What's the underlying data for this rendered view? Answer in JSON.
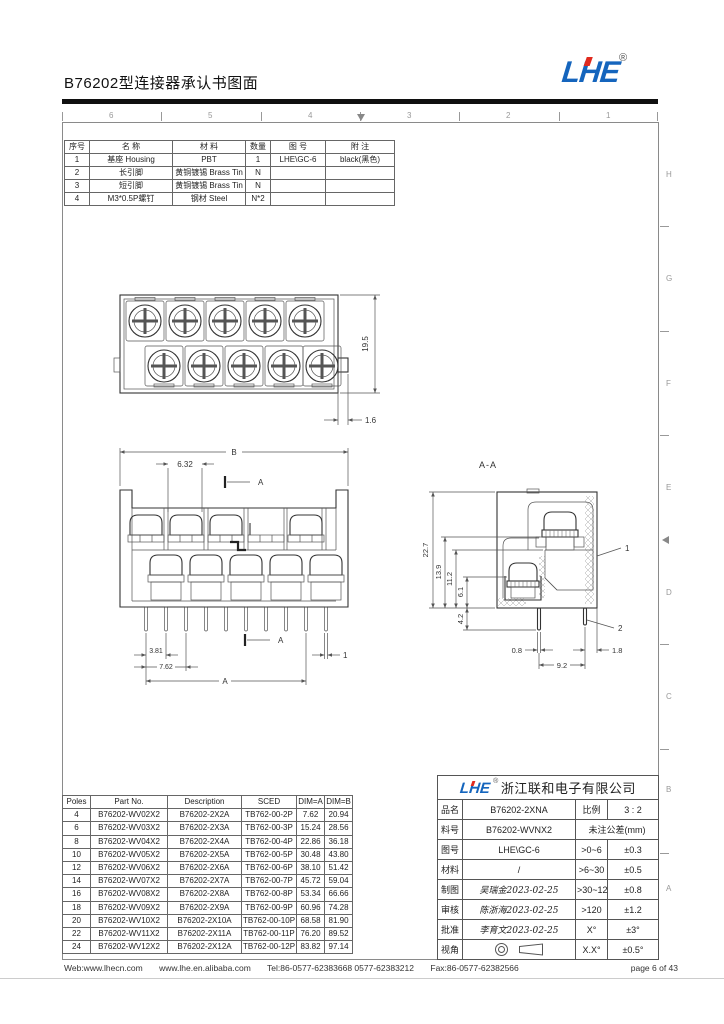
{
  "header": {
    "title": "B76202型连接器承认书图面",
    "logo_text": "LHE",
    "logo_reg": "®"
  },
  "sheet": {
    "top_zones": [
      "6",
      "5",
      "4",
      "3",
      "2",
      "1"
    ],
    "right_zones": [
      "H",
      "G",
      "F",
      "E",
      "D",
      "C",
      "B",
      "A"
    ]
  },
  "bom_table": {
    "headers": [
      "序号",
      "名    称",
      "材    料",
      "数量",
      "图    号",
      "附    注"
    ],
    "rows": [
      [
        "1",
        "基座 Housing",
        "PBT",
        "1",
        "LHE\\GC-6",
        "black(黑色)"
      ],
      [
        "2",
        "长引脚",
        "黄铜镀锡 Brass Tin",
        "N",
        "",
        ""
      ],
      [
        "3",
        "短引脚",
        "黄铜镀锡 Brass Tin",
        "N",
        "",
        ""
      ],
      [
        "4",
        "M3*0.5P螺钉",
        "钢材 Steel",
        "N*2",
        "",
        ""
      ]
    ]
  },
  "top_view": {
    "dim_height": "19.5",
    "dim_offset": "1.6"
  },
  "front_view": {
    "dim_b": "B",
    "dim_pitch": "6.32",
    "section_label_top": "A",
    "section_label_bottom": "A",
    "dim_3_81": "3.81",
    "dim_7_62": "7.62",
    "dim_a": "A",
    "dim_pin": "1"
  },
  "section_view": {
    "title": "A-A",
    "dim_total": "22.7",
    "dim_13_9": "13.9",
    "dim_11_2": "11.2",
    "dim_6_1": "6.1",
    "dim_4_2": "4.2",
    "dim_0_8": "0.8",
    "dim_9_2": "9.2",
    "dim_1_8": "1.8",
    "callout_1": "1",
    "callout_2": "2"
  },
  "poles_table": {
    "headers": [
      "Poles",
      "Part No.",
      "Description",
      "SCED",
      "DIM=A",
      "DIM=B"
    ],
    "rows": [
      [
        "4",
        "B76202-WV02X2",
        "B76202-2X2A",
        "TB762-00-2P",
        "7.62",
        "20.94"
      ],
      [
        "6",
        "B76202-WV03X2",
        "B76202-2X3A",
        "TB762-00-3P",
        "15.24",
        "28.56"
      ],
      [
        "8",
        "B76202-WV04X2",
        "B76202-2X4A",
        "TB762-00-4P",
        "22.86",
        "36.18"
      ],
      [
        "10",
        "B76202-WV05X2",
        "B76202-2X5A",
        "TB762-00-5P",
        "30.48",
        "43.80"
      ],
      [
        "12",
        "B76202-WV06X2",
        "B76202-2X6A",
        "TB762-00-6P",
        "38.10",
        "51.42"
      ],
      [
        "14",
        "B76202-WV07X2",
        "B76202-2X7A",
        "TB762-00-7P",
        "45.72",
        "59.04"
      ],
      [
        "16",
        "B76202-WV08X2",
        "B76202-2X8A",
        "TB762-00-8P",
        "53.34",
        "66.66"
      ],
      [
        "18",
        "B76202-WV09X2",
        "B76202-2X9A",
        "TB762-00-9P",
        "60.96",
        "74.28"
      ],
      [
        "20",
        "B76202-WV10X2",
        "B76202-2X10A",
        "TB762-00-10P",
        "68.58",
        "81.90"
      ],
      [
        "22",
        "B76202-WV11X2",
        "B76202-2X11A",
        "TB762-00-11P",
        "76.20",
        "89.52"
      ],
      [
        "24",
        "B76202-WV12X2",
        "B76202-2X12A",
        "TB762-00-12P",
        "83.82",
        "97.14"
      ]
    ]
  },
  "title_block": {
    "logo_text": "LHE",
    "logo_reg": "®",
    "company": "浙江联和电子有限公司",
    "pinming_label": "品名",
    "pinming_value": "B76202-2XNA",
    "bili_label": "比例",
    "bili_value": "3 : 2",
    "liaohao_label": "料号",
    "liaohao_value": "B76202-WVNX2",
    "tol_title": "未注公差(mm)",
    "tuhao_label": "图号",
    "tuhao_value": "LHE\\GC-6",
    "tol1_range": ">0~6",
    "tol1_val": "±0.3",
    "cailiao_label": "材料",
    "cailiao_value": "/",
    "tol2_range": ">6~30",
    "tol2_val": "±0.5",
    "zhitu_label": "制图",
    "zhitu_value": "吴瑞金2023-02-25",
    "tol3_range": ">30~120",
    "tol3_val": "±0.8",
    "shenhe_label": "审核",
    "shenhe_value": "陈浙海2023-02-25",
    "tol4_range": ">120",
    "tol4_val": "±1.2",
    "pizhun_label": "批准",
    "pizhun_value": "李育文2023-02-25",
    "ang1_range": "X°",
    "ang1_val": "±3°",
    "shijiao_label": "视角",
    "ang2_range": "X.X°",
    "ang2_val": "±0.5°"
  },
  "footer": {
    "web": "Web:www.lhecn.com",
    "alibaba": "www.lhe.en.alibaba.com",
    "tel": "Tel:86-0577-62383668  0577-62383212",
    "fax": "Fax:86-0577-62382566",
    "page": "page 6 of 43"
  }
}
